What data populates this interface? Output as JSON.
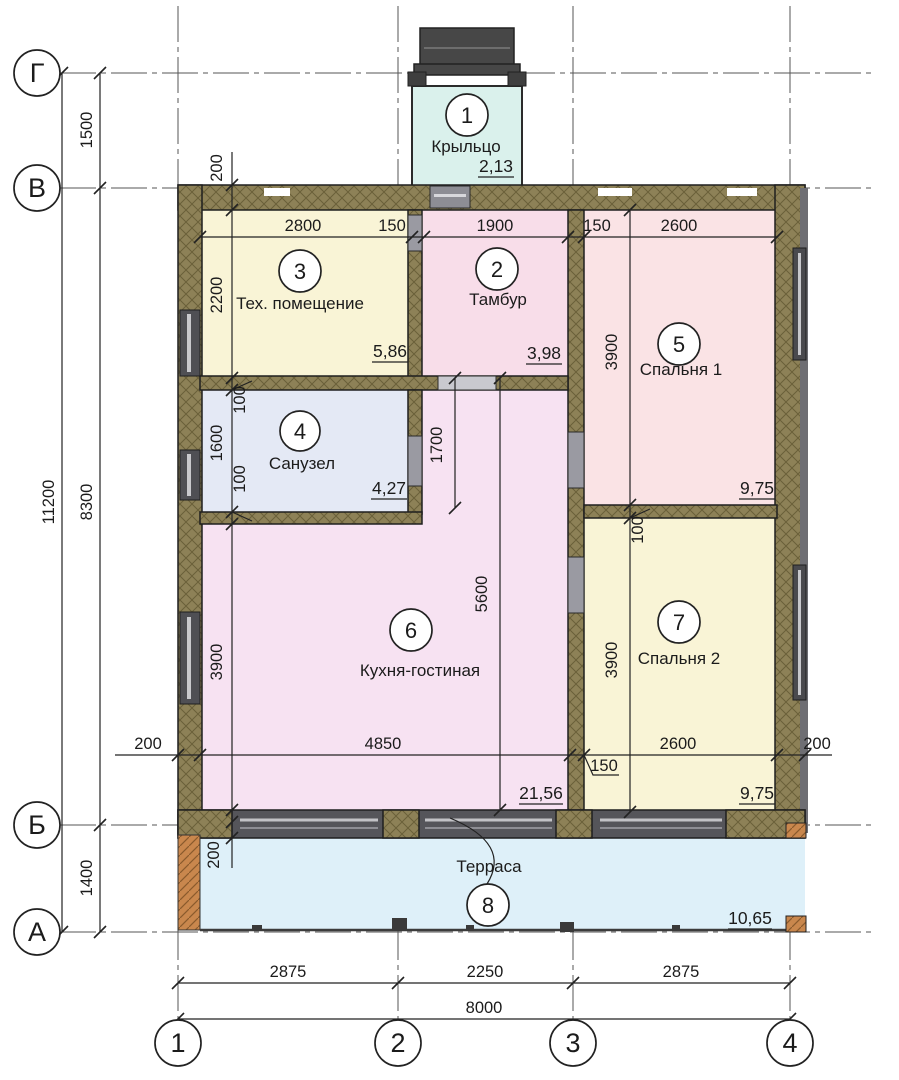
{
  "drawing": {
    "title": "floor-plan",
    "axes": {
      "rows": [
        "Г",
        "В",
        "Б",
        "А"
      ],
      "cols": [
        "1",
        "2",
        "3",
        "4"
      ]
    },
    "rooms": [
      {
        "number": "1",
        "name": "Крыльцо",
        "area": "2,13"
      },
      {
        "number": "2",
        "name": "Тамбур",
        "area": "3,98"
      },
      {
        "number": "3",
        "name": "Тех. помещение",
        "area": "5,86"
      },
      {
        "number": "4",
        "name": "Санузел",
        "area": "4,27"
      },
      {
        "number": "5",
        "name": "Спальня 1",
        "area": "9,75"
      },
      {
        "number": "6",
        "name": "Кухня-гостиная",
        "area": "21,56"
      },
      {
        "number": "7",
        "name": "Спальня 2",
        "area": "9,75"
      },
      {
        "number": "8",
        "name": "Терраса",
        "area": "10,65"
      }
    ],
    "dims": {
      "left_total": "11200",
      "left_top": "1500",
      "left_mid": "8300",
      "left_bot": "1400",
      "bot_s1": "2875",
      "bot_s2": "2250",
      "bot_s3": "2875",
      "bot_total": "8000",
      "wall": "200",
      "top_tech": "2800",
      "top_gap1": "150",
      "top_tambur": "1900",
      "top_gap2": "150",
      "top_bed1": "2600",
      "tech_h": "2200",
      "bath_off1": "100",
      "bath_h": "1600",
      "bath_off2": "100",
      "opening_1700": "1700",
      "kitchen_w": "4850",
      "kitchen_h": "3900",
      "kitchen_5600": "5600",
      "bed1_h": "3900",
      "bed2_off": "100",
      "bed2_h": "3900",
      "bed2_w": "2600",
      "bed2_gap": "150"
    },
    "colors": {
      "wall_hatch": "#8d8157",
      "wall_hatch_line": "#6a6039",
      "porch": "#daf1ec",
      "tambur": "#f8dde9",
      "tech": "#f9f4d6",
      "bath": "#e4e9f5",
      "bed1": "#fae3e5",
      "kitchen": "#f7e2f2",
      "bed2": "#f9f4d6",
      "terrace": "#def0f9",
      "wood": "#c9874d"
    }
  }
}
